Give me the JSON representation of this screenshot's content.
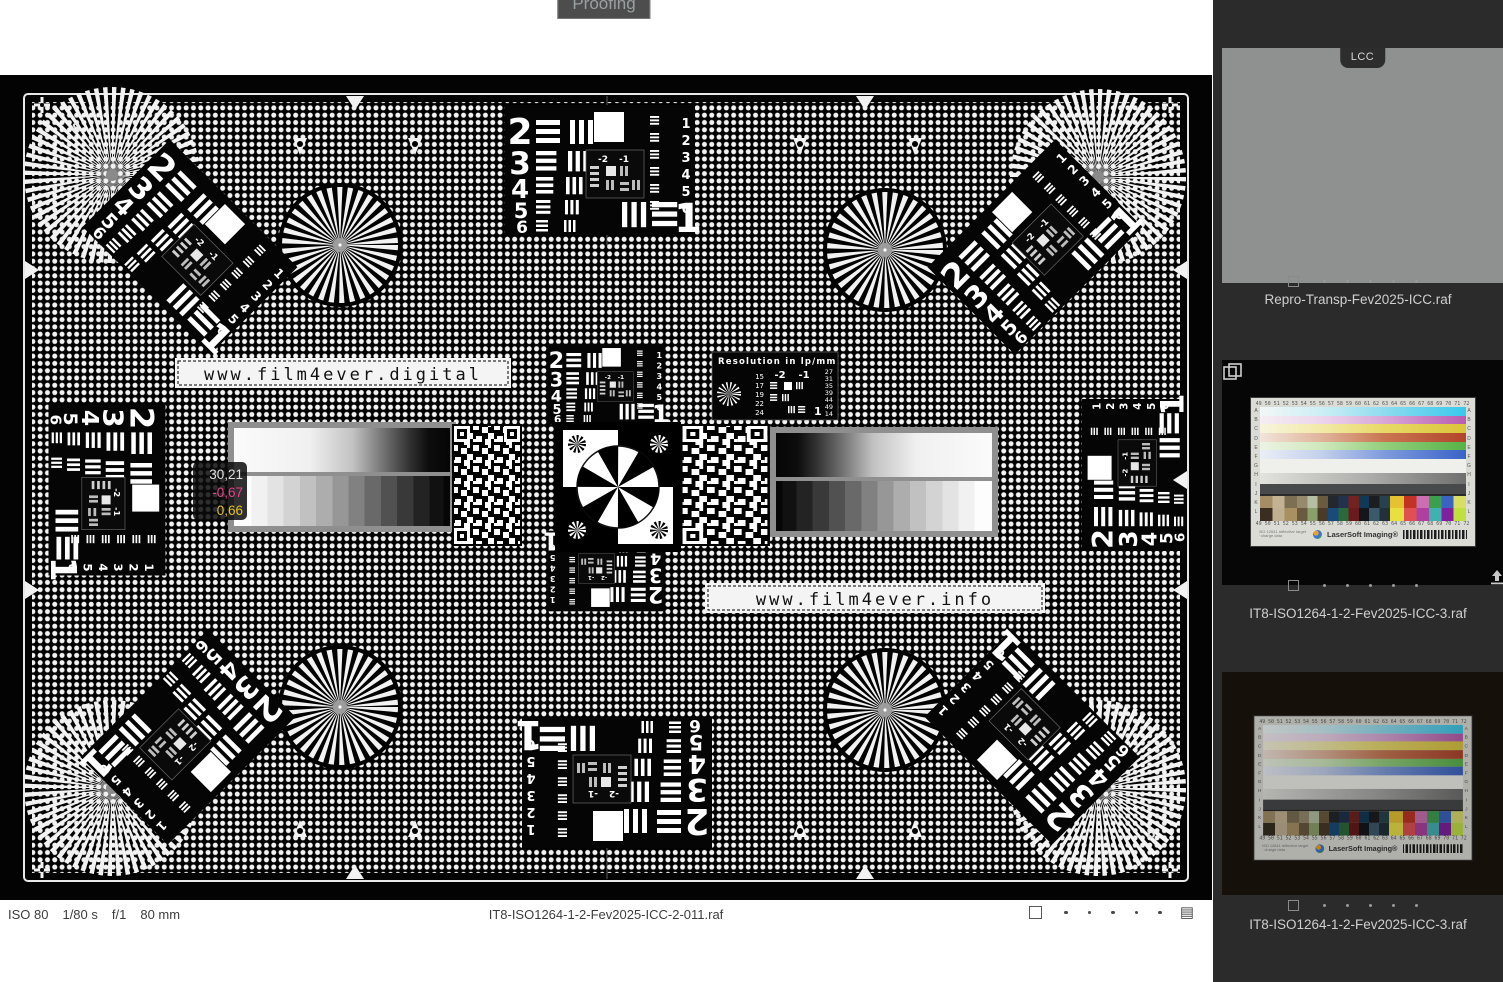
{
  "proofing": {
    "label": "Proofing"
  },
  "status_bar": {
    "iso": "ISO 80",
    "shutter": "1/80 s",
    "aperture": "f/1",
    "focal_length": "80 mm",
    "filename": "IT8-ISO1264-1-2-Fev2025-ICC-2-011.raf"
  },
  "chart": {
    "url_top": "www.film4ever.digital",
    "url_bottom": "www.film4ever.info",
    "readout": {
      "l": "30,21",
      "a": "-0,67",
      "b": "0,66"
    },
    "resolution_box": {
      "title": "Resolution in lp/mm",
      "minus2": "-2",
      "minus1": "-1",
      "left": [
        "15",
        "17",
        "19",
        "22",
        "24"
      ],
      "right": [
        "27",
        "31",
        "35",
        "39",
        "44",
        "49",
        "14"
      ]
    },
    "digits": [
      "2",
      "3",
      "4",
      "5",
      "6"
    ],
    "side_digits": [
      "1",
      "2",
      "3",
      "4",
      "5",
      "6"
    ],
    "big_one": "1",
    "frame_mark": "8"
  },
  "filmstrip": {
    "items": [
      {
        "badge": "LCC",
        "filename": "Repro-Transp-Fev2025-ICC.raf"
      },
      {
        "filename": "IT8-ISO1264-1-2-Fev2025-ICC-3.raf"
      },
      {
        "filename": "IT8-ISO1264-1-2-Fev2025-ICC-3.raf"
      }
    ],
    "it8": {
      "top_numbers": "49 50 51 52 53 54 55 56 57 58 59 60 61 62 63 64 65 66 67 68 69 70 71 72",
      "letters": "A B C D E F G H I J K L",
      "brand": "LaserSoft Imaging®"
    }
  },
  "icons": {
    "list_view": "▤"
  },
  "colors": {
    "panel_bg": "#2b2b2b",
    "thumb_gray": "#8e918f",
    "readout_l": "#e0e0e0",
    "readout_a": "#e8418c",
    "readout_b": "#e3c320",
    "filename_text": "#cfcfcf",
    "status_text": "#3d3d3d",
    "it8_bands": [
      "#38c8ec",
      "#b85cb0",
      "#dbc43a",
      "#b2442a",
      "#57b347",
      "#3a63c8"
    ]
  }
}
